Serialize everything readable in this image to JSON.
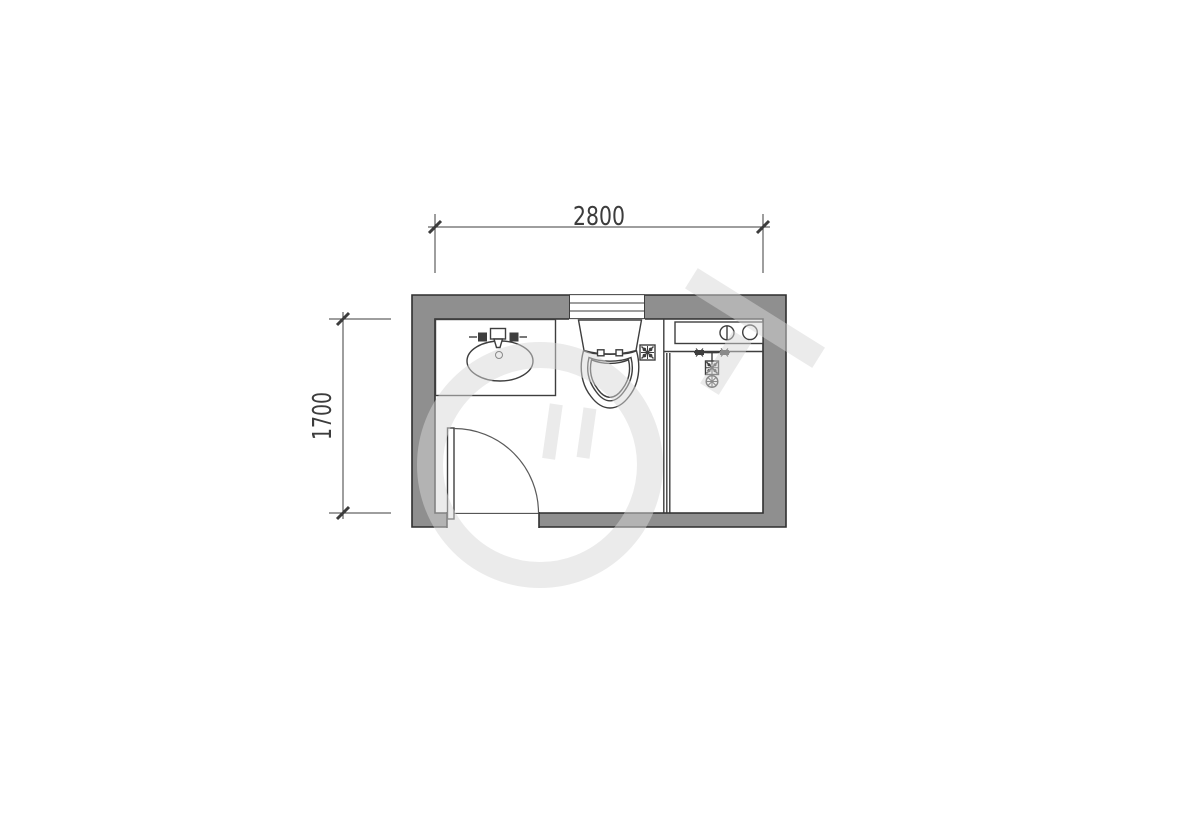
{
  "colors": {
    "wall_fill": "#8f8f8f",
    "wall_outline": "#2f2f2f",
    "fixture_line": "#3e3e3e",
    "dim_line": "#3c3c3c",
    "dim_text": "#3c3c3c",
    "watermark": "#d6d6d6",
    "background": "#ffffff"
  },
  "dimensions": {
    "width": {
      "label": "2800"
    },
    "height": {
      "label": "1700"
    }
  },
  "icons": {
    "window": "window-icon",
    "vanity_sink": "vanity-sink-icon",
    "faucet": "faucet-icon",
    "toilet": "toilet-icon",
    "floor_drain": "floor-drain-icon",
    "laundry_counter": "laundry-counter-icon",
    "shower_mixer": "shower-mixer-icon",
    "glass_partition": "glass-partition-icon",
    "door_swing": "door-swing-icon"
  }
}
